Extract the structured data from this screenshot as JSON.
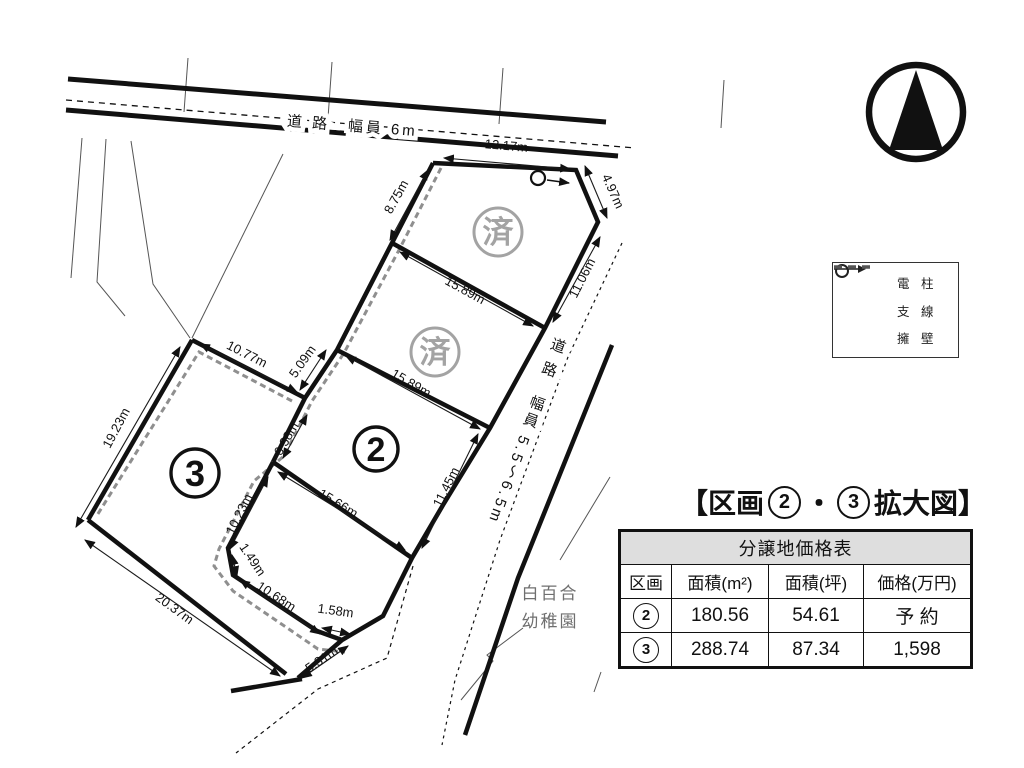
{
  "compass": {
    "icon": "north-arrow"
  },
  "roads": {
    "top_label": "道 路　幅員 6m",
    "right_label": "道 路　幅員 5.5～6.5m"
  },
  "landmark": {
    "line1": "白百合",
    "line2": "幼稚園"
  },
  "plots": {
    "plot2_label": "2",
    "plot3_label": "3",
    "sold_label": "済"
  },
  "dimensions": [
    {
      "label": "12.17m"
    },
    {
      "label": "4.97m"
    },
    {
      "label": "11.06m"
    },
    {
      "label": "8.75m"
    },
    {
      "label": "15.89m"
    },
    {
      "label": "15.89m"
    },
    {
      "label": "5.09m"
    },
    {
      "label": "10.77m"
    },
    {
      "label": "19.23m"
    },
    {
      "label": "6.38m"
    },
    {
      "label": "10.23m"
    },
    {
      "label": "1.49m"
    },
    {
      "label": "10.68m"
    },
    {
      "label": "1.58m"
    },
    {
      "label": "11.45m"
    },
    {
      "label": "15.66m"
    },
    {
      "label": "20.37m"
    },
    {
      "label": "5.31m"
    }
  ],
  "legend": {
    "items": [
      {
        "icon": "utility-pole-icon",
        "label": "電 柱"
      },
      {
        "icon": "guy-wire-icon",
        "label": "支 線"
      },
      {
        "icon": "retaining-wall-icon",
        "label": "擁 壁"
      }
    ]
  },
  "title": {
    "prefix": "【区画",
    "num1": "2",
    "sep": "・",
    "num2": "3",
    "suffix": "拡大図】"
  },
  "table": {
    "caption": "分譲地価格表",
    "headers": [
      "区画",
      "面積(m²)",
      "面積(坪)",
      "価格(万円)"
    ],
    "rows": [
      {
        "lot": "2",
        "area_m2": "180.56",
        "area_tsubo": "54.61",
        "price": "予 約"
      },
      {
        "lot": "3",
        "area_m2": "288.74",
        "area_tsubo": "87.34",
        "price": "1,598"
      }
    ]
  },
  "colors": {
    "line_black": "#111111",
    "sold_gray": "#a3a3a3",
    "wall_gray": "#8f8f8f",
    "table_header_bg": "#dedede"
  }
}
